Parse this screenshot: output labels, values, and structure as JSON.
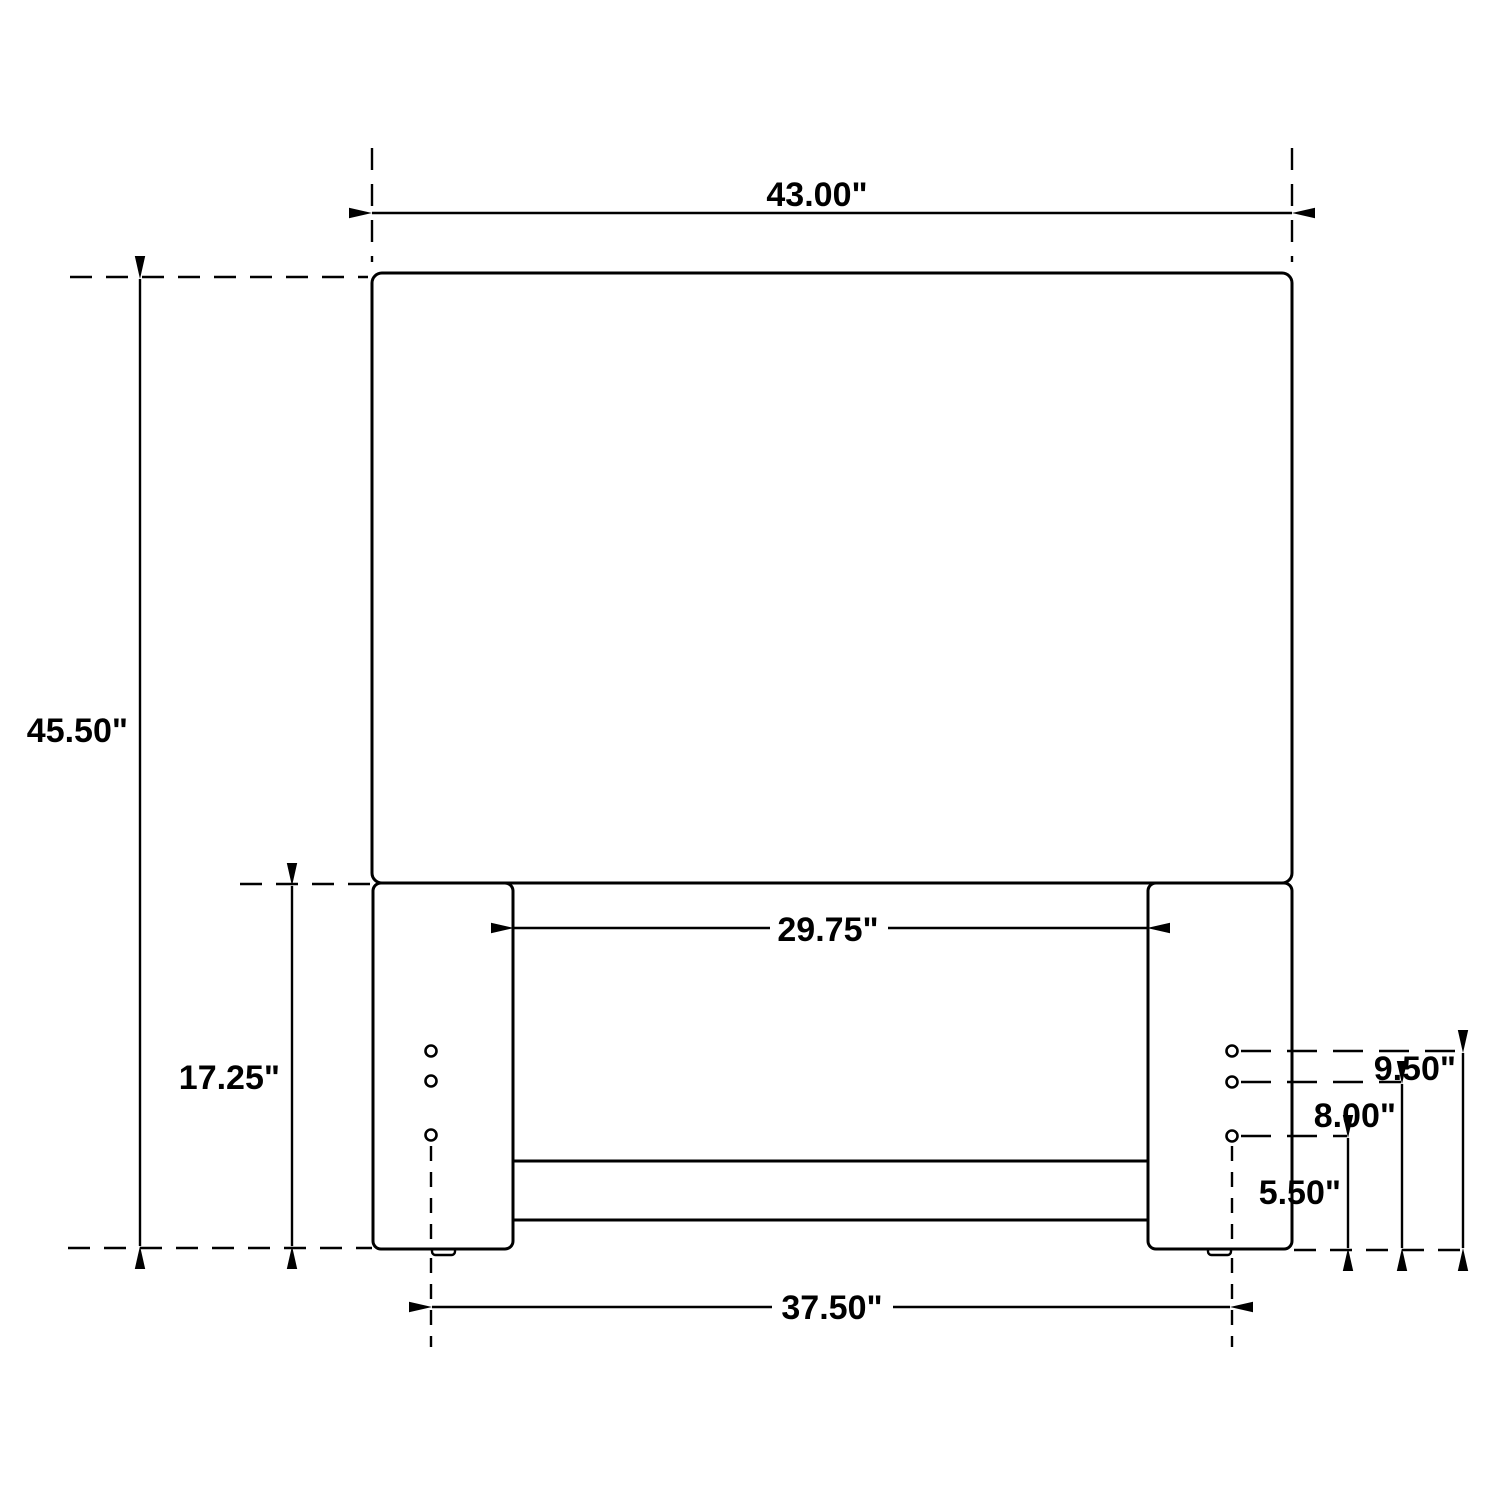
{
  "drawing": {
    "background_color": "#ffffff",
    "line_color": "#000000",
    "text_color": "#000000",
    "labels": {
      "overall_width": "43.00\"",
      "overall_height": "45.50\"",
      "leg_height": "17.25\"",
      "between_legs_width": "29.75\"",
      "leg_centerline_span": "37.50\"",
      "hole_height_top": "9.50\"",
      "hole_height_middle": "8.00\"",
      "hole_height_bottom": "5.50\""
    }
  }
}
